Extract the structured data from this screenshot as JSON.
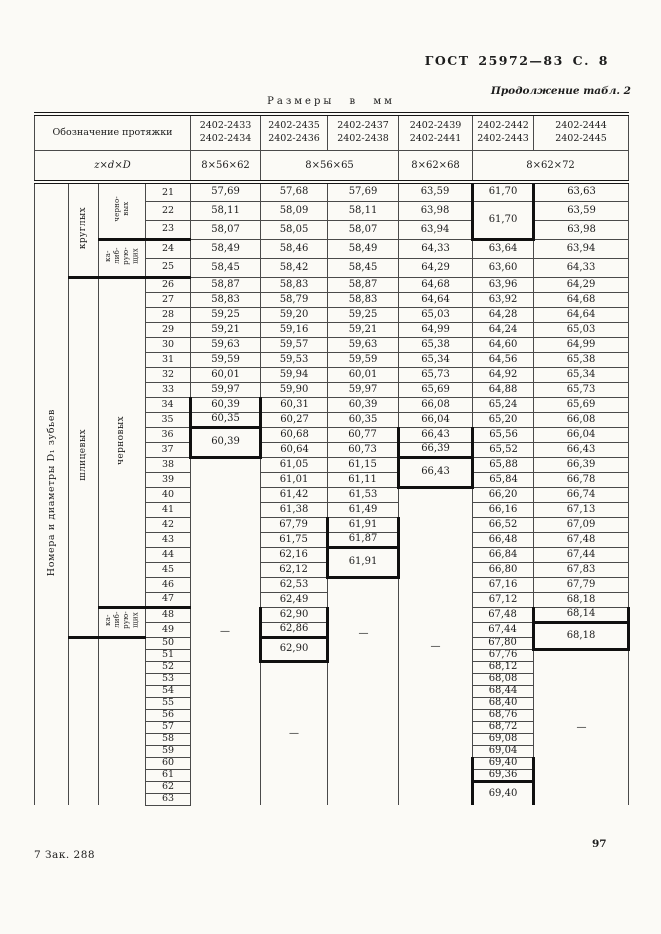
{
  "page": {
    "gost_header": "ГОСТ 25972—83 С. 8",
    "continuation": "Продолжение табл. 2",
    "units_note": "Размеры в мм",
    "footer_left": "7 Зак. 288",
    "page_number": "97"
  },
  "table": {
    "stub_header": "Обозначение протяжки",
    "param_label": "z×d×D",
    "designations": [
      [
        "2402-2433",
        "2402-2434"
      ],
      [
        "2402-2435",
        "2402-2436"
      ],
      [
        "2402-2437",
        "2402-2438"
      ],
      [
        "2402-2439",
        "2402-2441"
      ],
      [
        "2402-2442",
        "2402-2443"
      ],
      [
        "2402-2444",
        "2402-2445"
      ]
    ],
    "sizes": [
      {
        "label": "8×56×62",
        "span": 1
      },
      {
        "label": "8×56×65",
        "span": 2
      },
      {
        "label": "8×62×68",
        "span": 1
      },
      {
        "label": "8×62×72",
        "span": 2
      }
    ],
    "axis_label": "Номера и диаметры D₁ зубьев",
    "tooth_groups": {
      "level2": [
        [
          21,
          5,
          [
            "круглых"
          ],
          "bt"
        ],
        [
          26,
          24,
          [
            "шлицевых"
          ],
          "bt"
        ],
        [
          50,
          14,
          [
            ""
          ],
          ""
        ]
      ],
      "level3": [
        [
          21,
          3,
          [
            "черно-",
            "вых"
          ],
          "bt"
        ],
        [
          24,
          2,
          [
            "ка-",
            "либ-",
            "рую-",
            "щих"
          ],
          "bt"
        ],
        [
          26,
          22,
          [
            "черновых"
          ],
          "bt"
        ],
        [
          48,
          2,
          [
            "ка-",
            "либ-",
            "рую-",
            "щих"
          ],
          "bt"
        ],
        [
          50,
          14,
          [
            ""
          ],
          ""
        ]
      ]
    },
    "row_start": 21,
    "row_end": 63,
    "thick_row_numbers": [
      23,
      25,
      47
    ],
    "columns": [
      [
        [
          21,
          1,
          "57,69"
        ],
        [
          22,
          1,
          "58,11"
        ],
        [
          23,
          1,
          "58,07"
        ],
        [
          24,
          1,
          "58,49"
        ],
        [
          25,
          1,
          "58,45"
        ],
        [
          26,
          1,
          "58,87"
        ],
        [
          27,
          1,
          "58,83"
        ],
        [
          28,
          1,
          "59,25"
        ],
        [
          29,
          1,
          "59,21"
        ],
        [
          30,
          1,
          "59,63"
        ],
        [
          31,
          1,
          "59,59"
        ],
        [
          32,
          1,
          "60,01"
        ],
        [
          33,
          1,
          "59,97"
        ],
        [
          34,
          1,
          "60,39",
          "vt"
        ],
        [
          35,
          1,
          "60,35",
          "vt bt"
        ],
        [
          36,
          2,
          "60,39",
          "vt bt"
        ],
        [
          38,
          26,
          "—"
        ]
      ],
      [
        [
          21,
          1,
          "57,68"
        ],
        [
          22,
          1,
          "58,09"
        ],
        [
          23,
          1,
          "58,05"
        ],
        [
          24,
          1,
          "58,46"
        ],
        [
          25,
          1,
          "58,42"
        ],
        [
          26,
          1,
          "58,83"
        ],
        [
          27,
          1,
          "58,79"
        ],
        [
          28,
          1,
          "59,20"
        ],
        [
          29,
          1,
          "59,16"
        ],
        [
          30,
          1,
          "59,57"
        ],
        [
          31,
          1,
          "59,53"
        ],
        [
          32,
          1,
          "59,94"
        ],
        [
          33,
          1,
          "59,90"
        ],
        [
          34,
          1,
          "60,31"
        ],
        [
          35,
          1,
          "60,27"
        ],
        [
          36,
          1,
          "60,68"
        ],
        [
          37,
          1,
          "60,64"
        ],
        [
          38,
          1,
          "61,05"
        ],
        [
          39,
          1,
          "61,01"
        ],
        [
          40,
          1,
          "61,42"
        ],
        [
          41,
          1,
          "61,38"
        ],
        [
          42,
          1,
          "67,79"
        ],
        [
          43,
          1,
          "61,75"
        ],
        [
          44,
          1,
          "62,16"
        ],
        [
          45,
          1,
          "62,12"
        ],
        [
          46,
          1,
          "62,53"
        ],
        [
          47,
          1,
          "62,49"
        ],
        [
          48,
          1,
          "62,90",
          "vt"
        ],
        [
          49,
          1,
          "62,86",
          "vt bt"
        ],
        [
          50,
          2,
          "62,90",
          "vt bt"
        ],
        [
          52,
          12,
          "—"
        ]
      ],
      [
        [
          21,
          1,
          "57,69"
        ],
        [
          22,
          1,
          "58,11"
        ],
        [
          23,
          1,
          "58,07"
        ],
        [
          24,
          1,
          "58,49"
        ],
        [
          25,
          1,
          "58,45"
        ],
        [
          26,
          1,
          "58,87"
        ],
        [
          27,
          1,
          "58,83"
        ],
        [
          28,
          1,
          "59,25"
        ],
        [
          29,
          1,
          "59,21"
        ],
        [
          30,
          1,
          "59,63"
        ],
        [
          31,
          1,
          "59,59"
        ],
        [
          32,
          1,
          "60,01"
        ],
        [
          33,
          1,
          "59,97"
        ],
        [
          34,
          1,
          "60,39"
        ],
        [
          35,
          1,
          "60,35"
        ],
        [
          36,
          1,
          "60,77"
        ],
        [
          37,
          1,
          "60,73"
        ],
        [
          38,
          1,
          "61,15"
        ],
        [
          39,
          1,
          "61,11"
        ],
        [
          40,
          1,
          "61,53"
        ],
        [
          41,
          1,
          "61,49"
        ],
        [
          42,
          1,
          "61,91",
          "vt"
        ],
        [
          43,
          1,
          "61,87",
          "vt bt"
        ],
        [
          44,
          2,
          "61,91",
          "vt bt"
        ],
        [
          46,
          18,
          "—",
          "hi"
        ]
      ],
      [
        [
          21,
          1,
          "63,59"
        ],
        [
          22,
          1,
          "63,98"
        ],
        [
          23,
          1,
          "63,94"
        ],
        [
          24,
          1,
          "64,33"
        ],
        [
          25,
          1,
          "64,29"
        ],
        [
          26,
          1,
          "64,68"
        ],
        [
          27,
          1,
          "64,64"
        ],
        [
          28,
          1,
          "65,03"
        ],
        [
          29,
          1,
          "64,99"
        ],
        [
          30,
          1,
          "65,38"
        ],
        [
          31,
          1,
          "65,34"
        ],
        [
          32,
          1,
          "65,73"
        ],
        [
          33,
          1,
          "65,69"
        ],
        [
          34,
          1,
          "66,08"
        ],
        [
          35,
          1,
          "66,04"
        ],
        [
          36,
          1,
          "66,43",
          "vt"
        ],
        [
          37,
          1,
          "66,39",
          "vt bt"
        ],
        [
          38,
          2,
          "66,43",
          "vt bt"
        ],
        [
          40,
          24,
          "—"
        ]
      ],
      [
        [
          21,
          1,
          "61,70",
          "vt"
        ],
        [
          22,
          2,
          "61,70",
          "vt bt"
        ],
        [
          24,
          1,
          "63,64"
        ],
        [
          25,
          1,
          "63,60"
        ],
        [
          26,
          1,
          "63,96"
        ],
        [
          27,
          1,
          "63,92"
        ],
        [
          28,
          1,
          "64,28"
        ],
        [
          29,
          1,
          "64,24"
        ],
        [
          30,
          1,
          "64,60"
        ],
        [
          31,
          1,
          "64,56"
        ],
        [
          32,
          1,
          "64,92"
        ],
        [
          33,
          1,
          "64,88"
        ],
        [
          34,
          1,
          "65,24"
        ],
        [
          35,
          1,
          "65,20"
        ],
        [
          36,
          1,
          "65,56"
        ],
        [
          37,
          1,
          "65,52"
        ],
        [
          38,
          1,
          "65,88"
        ],
        [
          39,
          1,
          "65,84"
        ],
        [
          40,
          1,
          "66,20"
        ],
        [
          41,
          1,
          "66,16"
        ],
        [
          42,
          1,
          "66,52"
        ],
        [
          43,
          1,
          "66,48"
        ],
        [
          44,
          1,
          "66,84"
        ],
        [
          45,
          1,
          "66,80"
        ],
        [
          46,
          1,
          "67,16"
        ],
        [
          47,
          1,
          "67,12"
        ],
        [
          48,
          1,
          "67,48"
        ],
        [
          49,
          1,
          "67,44"
        ],
        [
          50,
          1,
          "67,80"
        ],
        [
          51,
          1,
          "67,76"
        ],
        [
          52,
          1,
          "68,12"
        ],
        [
          53,
          1,
          "68,08"
        ],
        [
          54,
          1,
          "68,44"
        ],
        [
          55,
          1,
          "68,40"
        ],
        [
          56,
          1,
          "68,76"
        ],
        [
          57,
          1,
          "68,72"
        ],
        [
          58,
          1,
          "69,08"
        ],
        [
          59,
          1,
          "69,04"
        ],
        [
          60,
          1,
          "69,40",
          "vt"
        ],
        [
          61,
          1,
          "69,36",
          "vt bt"
        ],
        [
          62,
          2,
          "69,40",
          "vt"
        ]
      ],
      [
        [
          21,
          1,
          "63,63"
        ],
        [
          22,
          1,
          "63,59"
        ],
        [
          23,
          1,
          "63,98"
        ],
        [
          24,
          1,
          "63,94"
        ],
        [
          25,
          1,
          "64,33"
        ],
        [
          26,
          1,
          "64,29"
        ],
        [
          27,
          1,
          "64,68"
        ],
        [
          28,
          1,
          "64,64"
        ],
        [
          29,
          1,
          "65,03"
        ],
        [
          30,
          1,
          "64,99"
        ],
        [
          31,
          1,
          "65,38"
        ],
        [
          32,
          1,
          "65,34"
        ],
        [
          33,
          1,
          "65,73"
        ],
        [
          34,
          1,
          "65,69"
        ],
        [
          35,
          1,
          "66,08"
        ],
        [
          36,
          1,
          "66,04"
        ],
        [
          37,
          1,
          "66,43"
        ],
        [
          38,
          1,
          "66,39"
        ],
        [
          39,
          1,
          "66,78"
        ],
        [
          40,
          1,
          "66,74"
        ],
        [
          41,
          1,
          "67,13"
        ],
        [
          42,
          1,
          "67,09"
        ],
        [
          43,
          1,
          "67,48"
        ],
        [
          44,
          1,
          "67,44"
        ],
        [
          45,
          1,
          "67,83"
        ],
        [
          46,
          1,
          "67,79"
        ],
        [
          47,
          1,
          "68,18"
        ],
        [
          48,
          1,
          "68,14",
          "vt bt"
        ],
        [
          49,
          2,
          "68,18",
          "vt bt"
        ],
        [
          51,
          13,
          "—"
        ]
      ]
    ]
  }
}
